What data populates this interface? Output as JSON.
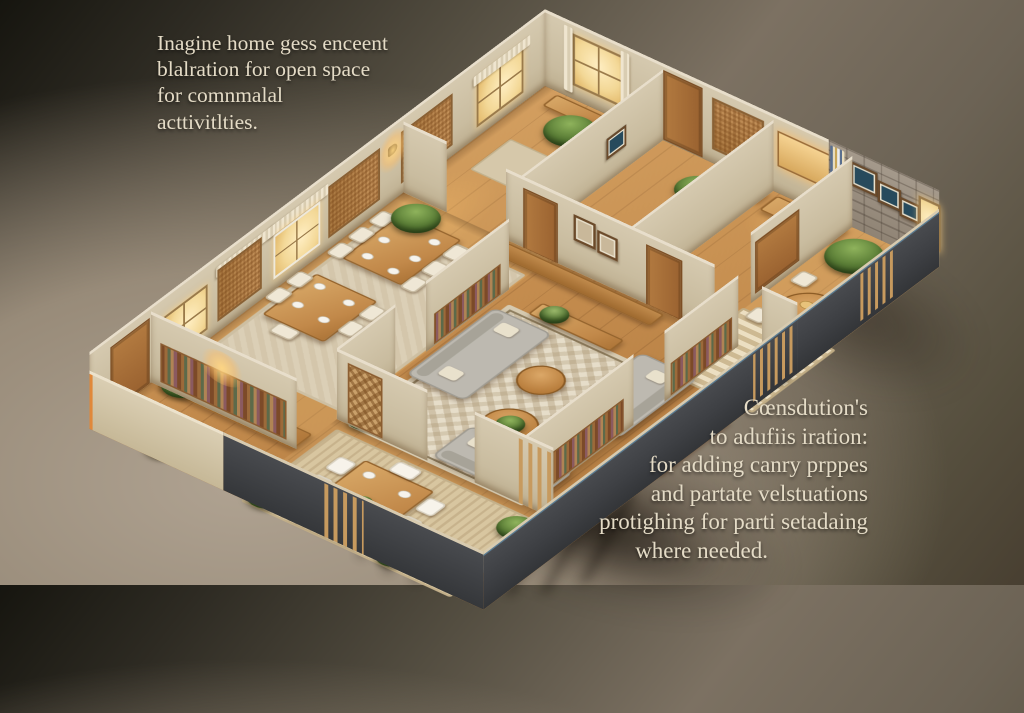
{
  "scene": {
    "description": "Isometric 3D cutaway model of a furnished apartment floor plan, warm wood interiors, viewed from above on a taupe studio background",
    "colors": {
      "background_dark": "#16150f",
      "background_light": "#b0a392",
      "wood_floor": "#c28a4c",
      "interior_wall": "#cdc0a5",
      "exterior_wall_dark": "#3f4144",
      "sofa_gray": "#bdb9b0",
      "rug_cream": "#e6ddc9",
      "plant_green": "#5d8038",
      "window_glow": "#f3d897",
      "slat_wood": "#c79a5e"
    }
  },
  "captions": {
    "top_left": {
      "lines": [
        "Inagine home gess enceent",
        "blalration for open space",
        "for comnmalal",
        "acttivitlties."
      ]
    },
    "bottom_right": {
      "lines": [
        "Cœnsdution's",
        "to adufiis iration:",
        "for adding canry prppes",
        "and partate velstuations",
        "protighing for parti setadaing",
        "where needed."
      ]
    }
  }
}
